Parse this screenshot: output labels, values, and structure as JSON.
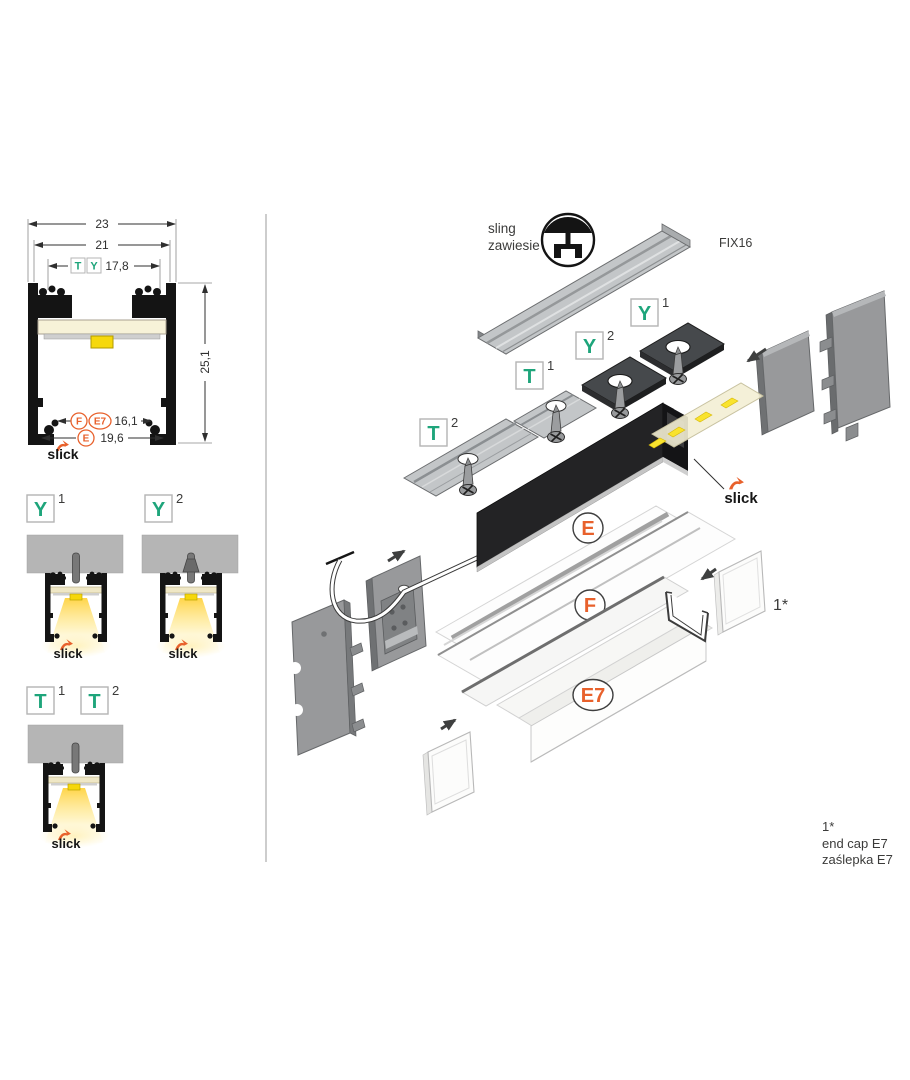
{
  "brand": "slick",
  "colors": {
    "teal_accent": "#1ea57b",
    "orange_accent": "#e8612c",
    "text_dark": "#3b3b3a",
    "profile_black": "#1d1d1f",
    "metal_gray": "#c3c6c8",
    "led_yellow": "#f6d70a",
    "light_glow": "#ffd23e"
  },
  "cross_section": {
    "dim_outer_width": "23",
    "dim_inner_width": "21",
    "dim_ty": {
      "badge1": "T",
      "badge2": "Y",
      "value": "17,8"
    },
    "dim_height": "25,1",
    "dim_fe7": {
      "badge1": "F",
      "badge2": "E7",
      "value": "16,1"
    },
    "dim_e": {
      "badge": "E",
      "value": "19,6"
    }
  },
  "variants": {
    "y1": {
      "letter": "Y",
      "sup": "1"
    },
    "y2": {
      "letter": "Y",
      "sup": "2"
    },
    "t1": {
      "letter": "T",
      "sup": "1"
    },
    "t2": {
      "letter": "T",
      "sup": "2"
    }
  },
  "exploded": {
    "sling": {
      "line1": "sling",
      "line2": "zawiesie"
    },
    "rail_name": "FIX16",
    "parts": {
      "e": "E",
      "f": "F",
      "e7": "E7"
    },
    "endcap_ref": "1*"
  },
  "footnote": {
    "ref": "1*",
    "line1": "end cap E7",
    "line2": "zaślepka E7"
  }
}
